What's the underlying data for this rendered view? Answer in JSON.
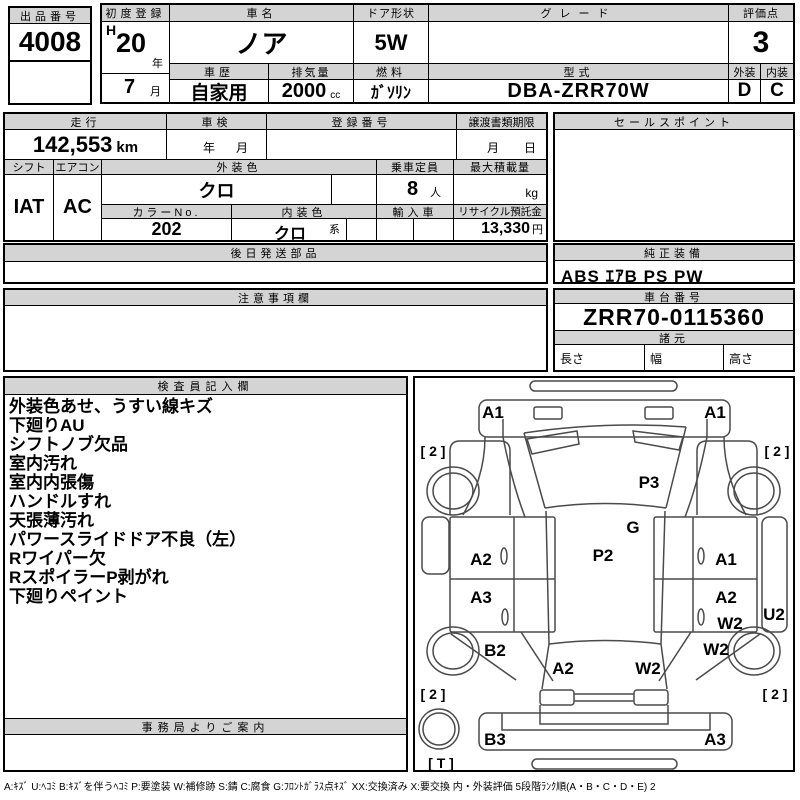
{
  "lot": {
    "label": "出品番号",
    "value": "4008"
  },
  "first_reg": {
    "label": "初度登録",
    "era": "H",
    "year": "20",
    "year_unit": "年",
    "month": "7",
    "month_unit": "月"
  },
  "car": {
    "name_label": "車名",
    "name": "ノア",
    "door_label": "ドア形状",
    "door": "5W",
    "grade_label": "グレード",
    "grade": "",
    "score_label": "評価点",
    "score": "3",
    "history_label": "車歴",
    "history": "自家用",
    "disp_label": "排気量",
    "disp": "2000",
    "disp_unit": "cc",
    "fuel_label": "燃料",
    "fuel": "ｶﾞｿﾘﾝ",
    "model_label": "型式",
    "model": "DBA-ZRR70W",
    "ext_label": "外装",
    "ext": "D",
    "int_label": "内装",
    "int": "C"
  },
  "status": {
    "mileage_label": "走行",
    "mileage": "142,553",
    "mileage_unit": "km",
    "shaken_label": "車検",
    "shaken_year_unit": "年",
    "shaken_month_unit": "月",
    "reg_label": "登録番号",
    "transfer_label": "譲渡書類期限",
    "transfer_month_unit": "月",
    "transfer_day_unit": "日",
    "sales_label": "セールスポイント",
    "shift_label": "シフト",
    "shift": "IAT",
    "ac_label": "エアコン",
    "ac": "AC",
    "ext_color_label": "外装色",
    "ext_color": "クロ",
    "capacity_label": "乗車定員",
    "capacity": "8",
    "capacity_unit": "人",
    "load_label": "最大積載量",
    "load_unit": "kg",
    "color_no_label": "カラーNo.",
    "color_no": "202",
    "int_color_label": "内装色",
    "int_color": "クロ",
    "int_color_suffix": "系",
    "import_label": "輸入車",
    "recycle_label": "リサイクル預託金",
    "recycle": "13,330",
    "recycle_unit": "円"
  },
  "sections": {
    "later_parts_label": "後日発送部品",
    "oem_label": "純正装備",
    "oem_value": "ABS ｴｱB PS PW",
    "caution_label": "注意事項欄",
    "chassis_label": "車台番号",
    "chassis": "ZRR70-0115360",
    "spec_label": "諸元",
    "spec_length": "長さ",
    "spec_width": "幅",
    "spec_height": "高さ",
    "inspector_label": "検査員記入欄",
    "office_label": "事務局よりご案内"
  },
  "inspector": {
    "lines": [
      "外装色あせ、うすい線キズ",
      "下廻りAU",
      "シフトノブ欠品",
      "室内汚れ",
      "室内内張傷",
      "ハンドルすれ",
      "天張薄汚れ",
      "パワースライドドア不良（左）",
      "Rワイパー欠",
      "RスポイラーP剥がれ",
      "下廻りペイント"
    ]
  },
  "diagram": {
    "labels": [
      "A1",
      "A1",
      "[ 2 ]",
      "[ 2 ]",
      "P3",
      "G",
      "A2",
      "P2",
      "A1",
      "A3",
      "A2",
      "U2",
      "W2",
      "B2",
      "W2",
      "A2",
      "W2",
      "[ 2 ]",
      "[ 2 ]",
      "B3",
      "A3",
      "[ T ]"
    ]
  },
  "legend": {
    "text": "A:ｷｽﾞ U:ﾍｺﾐ B:ｷｽﾞを伴うﾍｺﾐ P:要塗装 W:補修跡 S:錆 C:腐食 G:ﾌﾛﾝﾄｶﾞﾗｽ点ｷｽﾞ XX:交換済み X:要交換  内・外装評価  5段階ﾗﾝｸ順(A・B・C・D・E) 2"
  }
}
